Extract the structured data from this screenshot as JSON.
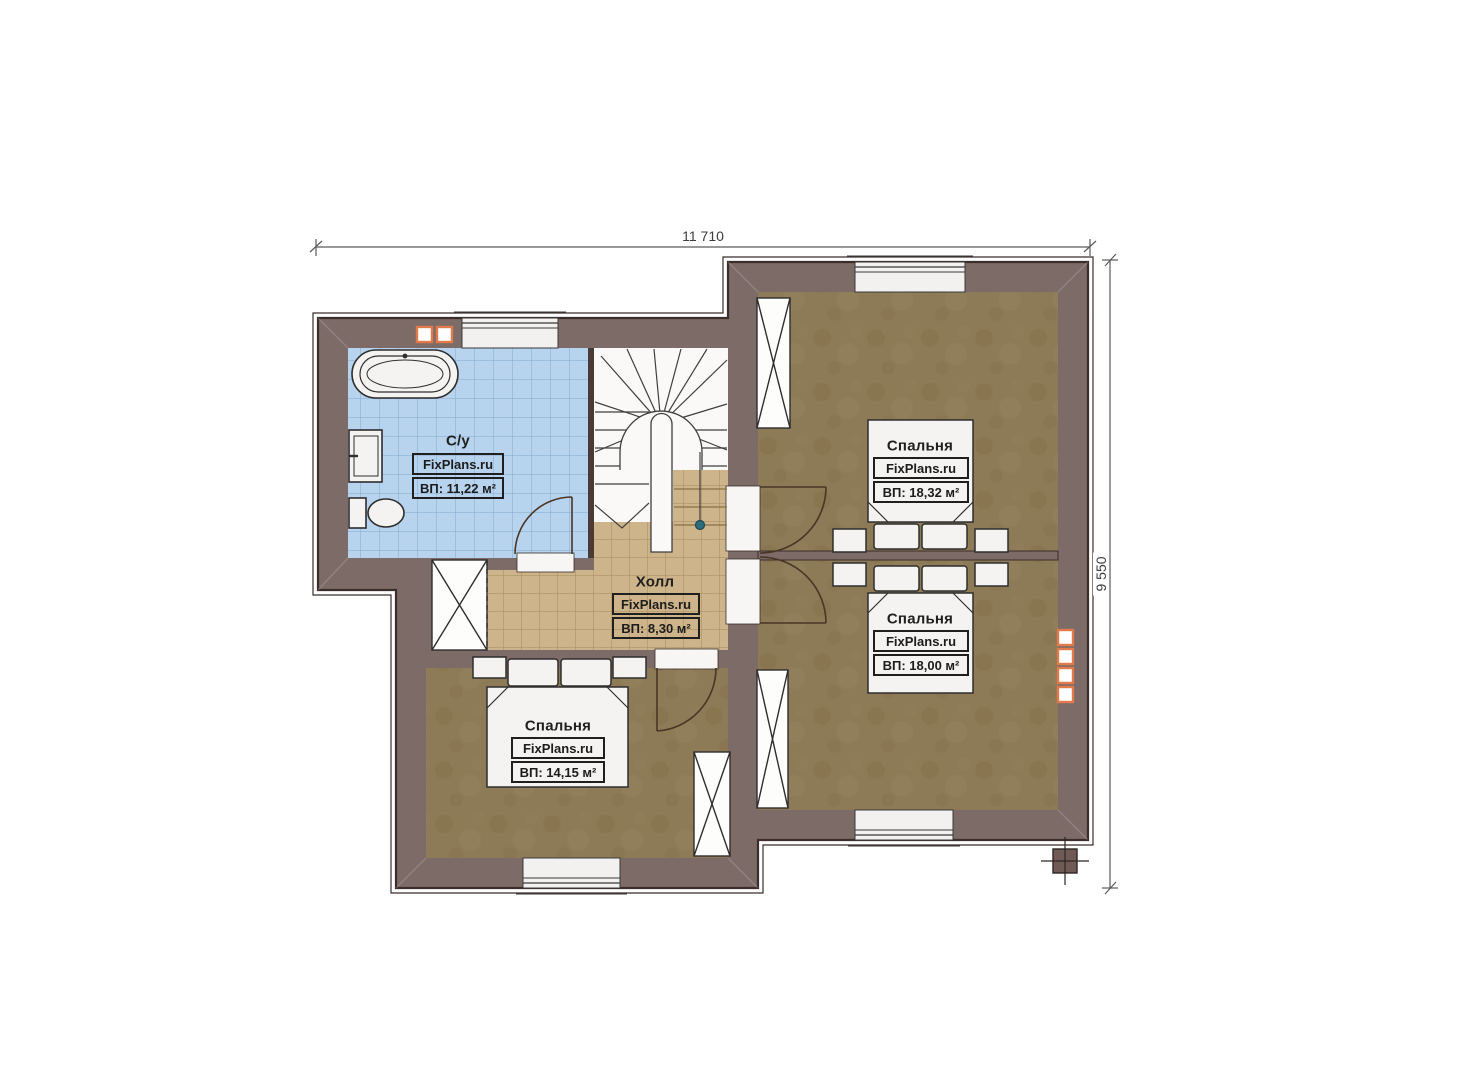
{
  "plan": {
    "type": "floor-plan",
    "dimension_top": "11 710",
    "dimension_right": "9 550",
    "rooms": {
      "bathroom": {
        "name": "С/у",
        "brand": "FixPlans.ru",
        "area": "ВП: 11,22 м²"
      },
      "hall": {
        "name": "Холл",
        "brand": "FixPlans.ru",
        "area": "ВП: 8,30 м²"
      },
      "bedroom_right_top": {
        "name": "Спальня",
        "brand": "FixPlans.ru",
        "area": "ВП: 18,32 м²"
      },
      "bedroom_right_bottom": {
        "name": "Спальня",
        "brand": "FixPlans.ru",
        "area": "ВП: 18,00 м²"
      },
      "bedroom_left_bottom": {
        "name": "Спальня",
        "brand": "FixPlans.ru",
        "area": "ВП: 14,15 м²"
      }
    },
    "colors": {
      "wall": "#7c6b67",
      "wall-outline": "#3a2d2a",
      "floor-brown": "#8d7a57",
      "floor-tan": "#cdb48a",
      "tan-grid": "#a58c5f",
      "floor-blue": "#b7d3ee",
      "blue-grid": "#86aace",
      "stair-bg": "#faf9f7",
      "furniture": "#f4f3f1",
      "furniture-outline": "#2e2e2e",
      "accent-orange": "#e2794b",
      "dim-line": "#5a5a5a",
      "newel-dot": "#2e6d7e"
    }
  }
}
